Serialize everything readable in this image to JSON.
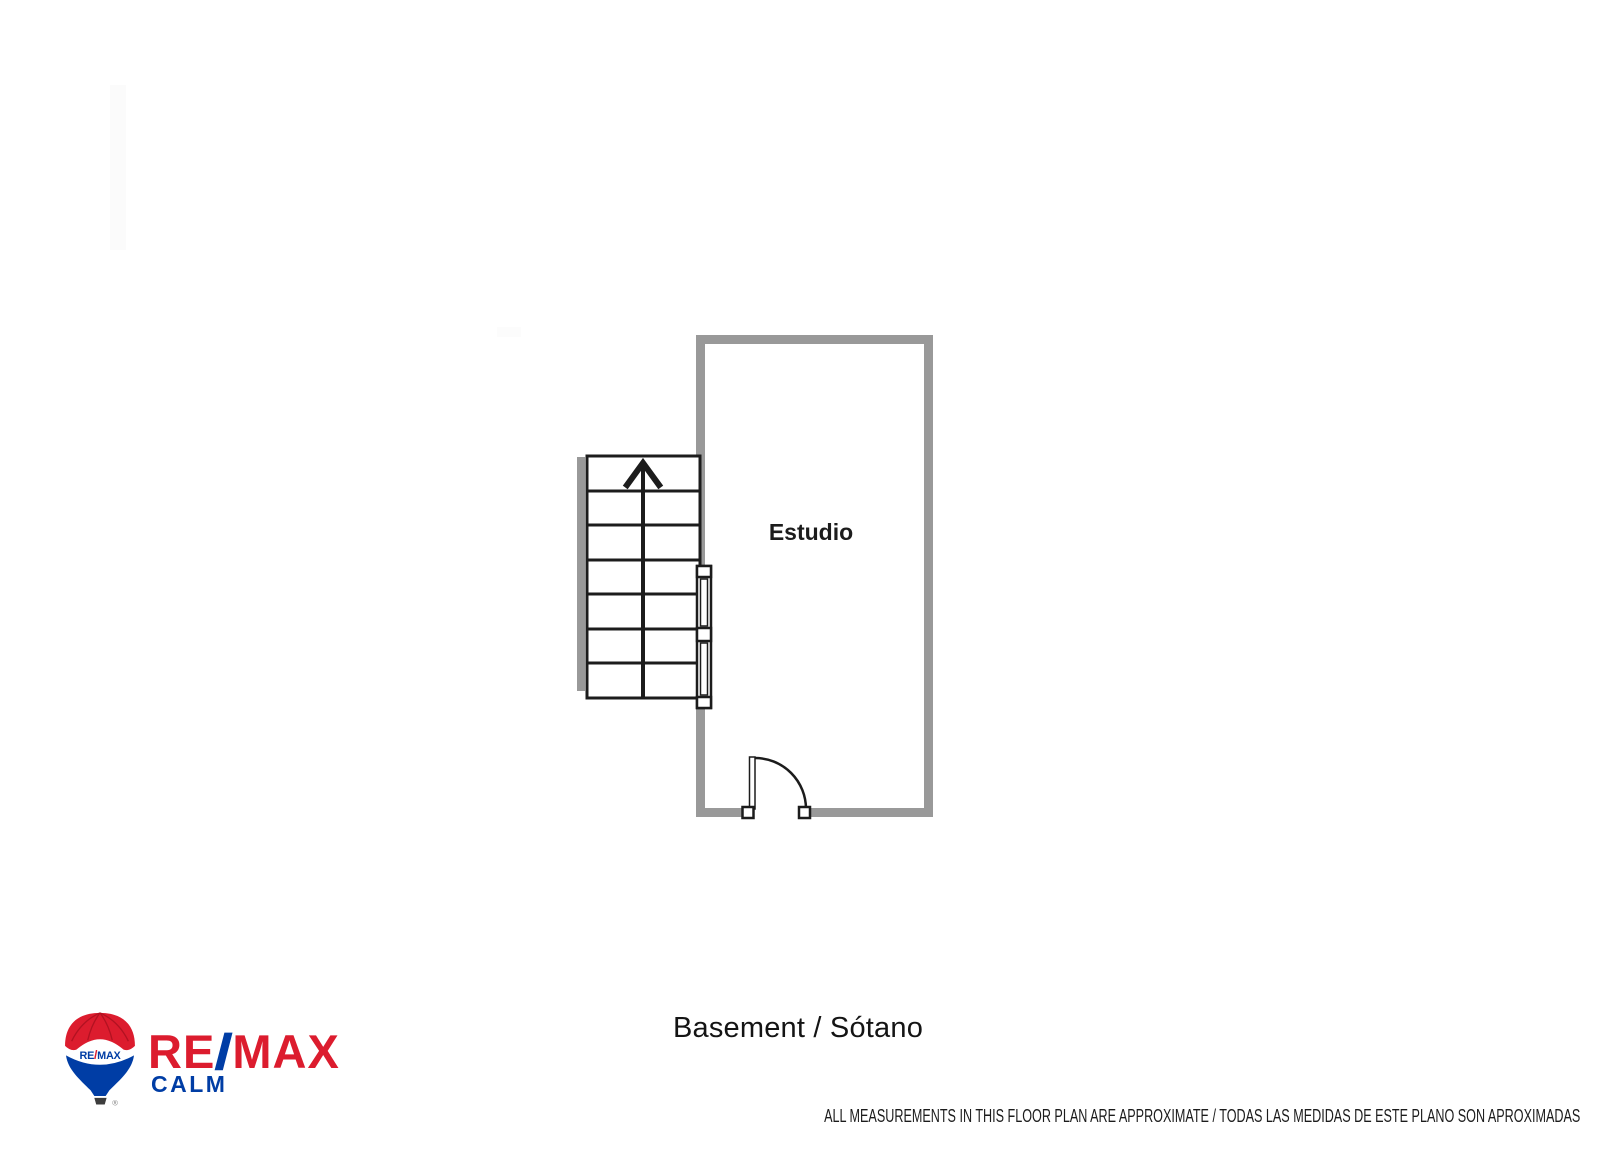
{
  "floor_plan": {
    "room_label": "Estudio",
    "caption": "Basement / Sótano",
    "disclaimer": "ALL MEASUREMENTS IN THIS FLOOR PLAN ARE APPROXIMATE / TODAS LAS MEDIDAS DE ESTE PLANO SON APROXIMADAS",
    "colors": {
      "wall": "#999999",
      "line": "#1c1c1c",
      "floor": "#ffffff"
    },
    "features": {
      "staircase_treads": 7,
      "stair_direction": "up",
      "door_count": 1,
      "window_segments": 2
    }
  },
  "logo": {
    "balloon_label_re": "RE",
    "balloon_label_slash": "/",
    "balloon_label_max": "MAX",
    "wordmark_re": "RE",
    "wordmark_slash": "/",
    "wordmark_max": "MAX",
    "office_name": "CALM",
    "registered_symbol": "®",
    "colors": {
      "red": "#dc1c2e",
      "blue": "#003da5"
    }
  }
}
